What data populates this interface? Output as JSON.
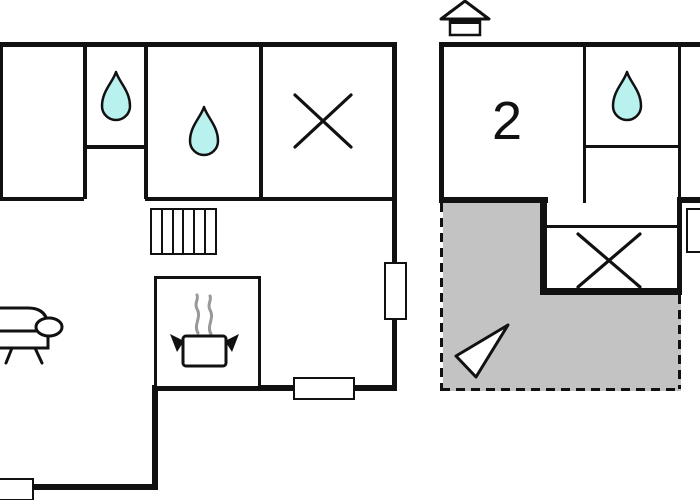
{
  "canvas": {
    "width": 700,
    "height": 500,
    "background": "#ffffff"
  },
  "colors": {
    "wall": "#111111",
    "water_drop_fill": "#b9f1ef",
    "terrace_fill": "#c3c3c3",
    "steam": "#999999",
    "window_fill": "#ffffff"
  },
  "left_building": {
    "rooms": [
      {
        "id": "top-left-room",
        "icon": ""
      },
      {
        "id": "bathroom-small",
        "icon": "water-drop-icon"
      },
      {
        "id": "bathroom-large",
        "icon": "water-drop-icon"
      },
      {
        "id": "crossed-room",
        "icon": "x-marker-icon"
      },
      {
        "id": "kitchen",
        "icon": "stove-pot-icon"
      },
      {
        "id": "living-room",
        "icon": "sofa-icon"
      }
    ],
    "features": [
      "stairs-icon",
      "window",
      "window",
      "window"
    ]
  },
  "right_building": {
    "entrance_icon": "house-entrance-icon",
    "rooms": [
      {
        "id": "bedroom",
        "label": "2"
      },
      {
        "id": "bathroom",
        "icon": "water-drop-icon"
      },
      {
        "id": "crossed-room",
        "icon": "x-marker-icon"
      }
    ],
    "features": [
      "window"
    ],
    "terrace": {
      "border": "dashed",
      "fill": "#c3c3c3",
      "icon": "direction-arrow-icon"
    }
  }
}
